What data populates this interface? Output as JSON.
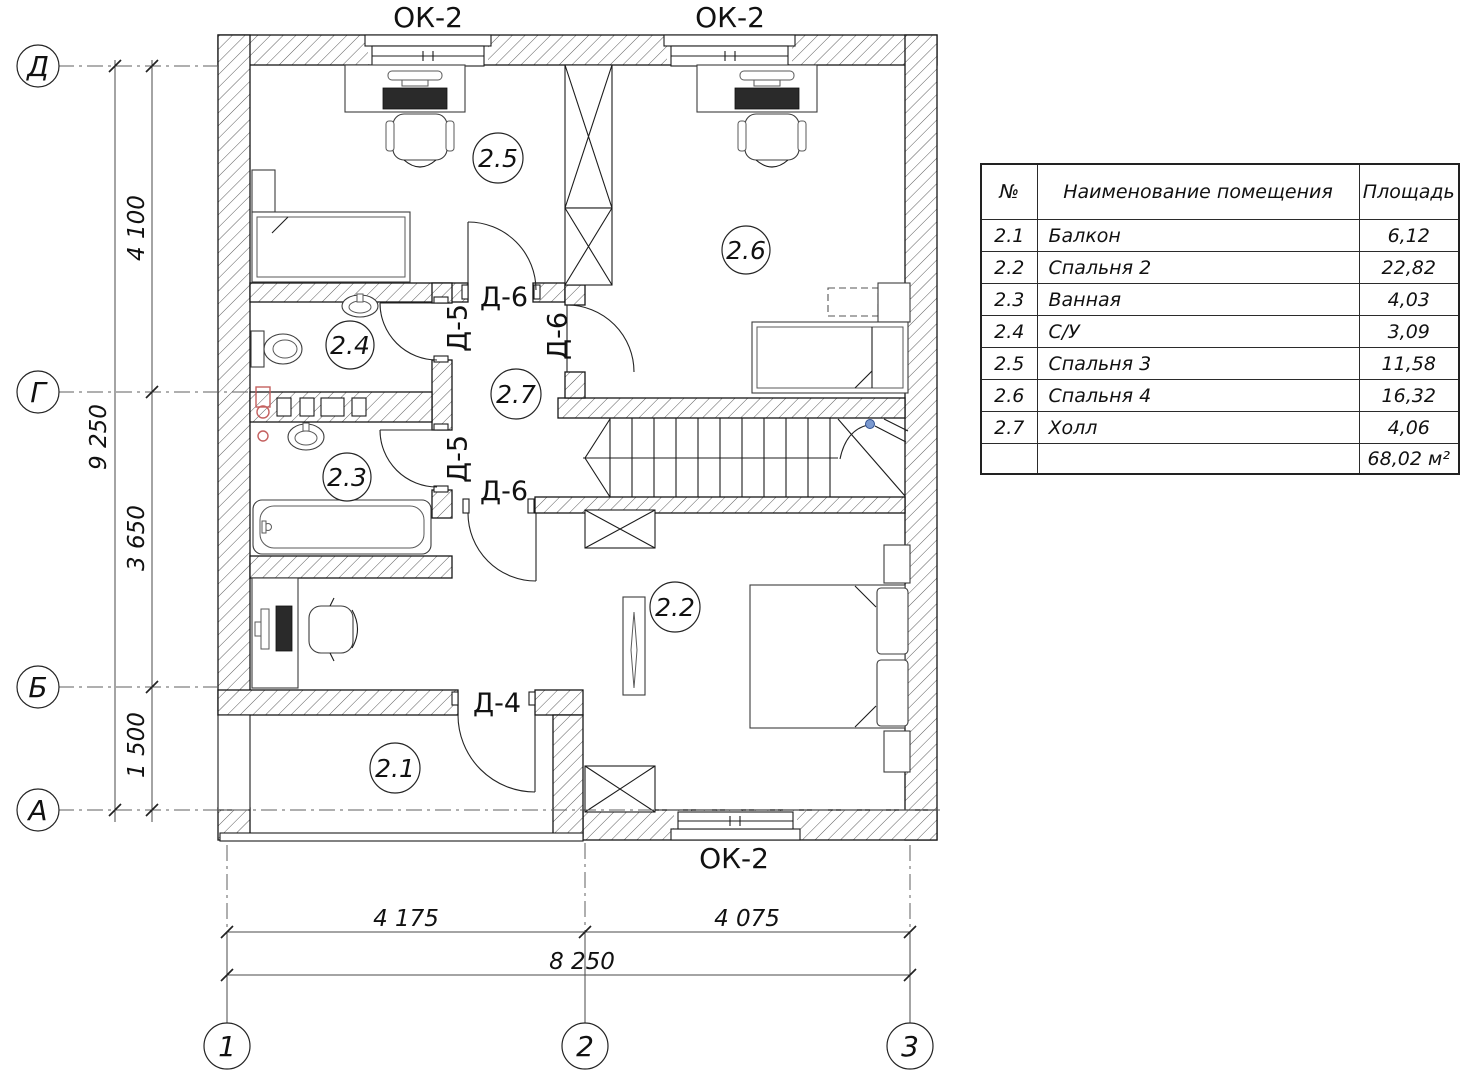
{
  "drawing": {
    "window_labels": {
      "top_left": "ОК-2",
      "top_right": "ОК-2",
      "bottom": "ОК-2"
    },
    "door_labels": {
      "d6_top": "Д-6",
      "d5_top": "Д-5",
      "d6_right": "Д-6",
      "d5_bottom": "Д-5",
      "d6_bottom": "Д-6",
      "d4": "Д-4"
    },
    "room_numbers": {
      "balcony": "2.1",
      "bedroom2": "2.2",
      "bath": "2.3",
      "wc": "2.4",
      "bedroom3": "2.5",
      "bedroom4": "2.6",
      "hall": "2.7"
    },
    "dimensions": {
      "left_total": "9 250",
      "span_top": "4 100",
      "span_mid": "3 650",
      "span_bottom": "1 500",
      "bottom_left": "4 175",
      "bottom_right": "4 075",
      "bottom_total": "8 250"
    },
    "axis_rows": {
      "d": "Д",
      "g": "Г",
      "b": "Б",
      "a": "А"
    },
    "axis_cols": {
      "c1": "1",
      "c2": "2",
      "c3": "3"
    }
  },
  "table": {
    "headers": {
      "num": "№",
      "name": "Наименование помещения",
      "area": "Площадь"
    },
    "rows": [
      {
        "num": "2.1",
        "name": "Балкон",
        "area": "6,12"
      },
      {
        "num": "2.2",
        "name": "Спальня 2",
        "area": "22,82"
      },
      {
        "num": "2.3",
        "name": "Ванная",
        "area": "4,03"
      },
      {
        "num": "2.4",
        "name": "С/У",
        "area": "3,09"
      },
      {
        "num": "2.5",
        "name": "Спальня 3",
        "area": "11,58"
      },
      {
        "num": "2.6",
        "name": "Спальня 4",
        "area": "16,32"
      },
      {
        "num": "2.7",
        "name": "Холл",
        "area": "4,06"
      }
    ],
    "total_area": "68,02 м²"
  },
  "colors": {
    "line": "#1c1c1c",
    "pipe_red": "#c4605f",
    "hinge_blue": "#7b99cf"
  }
}
